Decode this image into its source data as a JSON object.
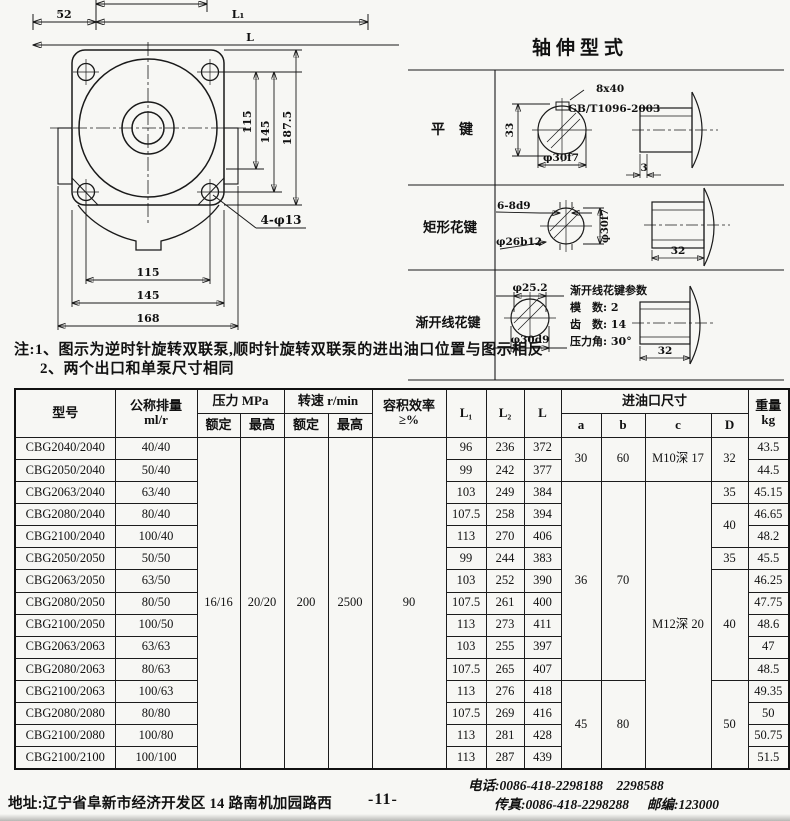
{
  "front_view": {
    "dim_top_52": "52",
    "dim_top_l1": "L₁",
    "dim_top_l": "L",
    "dim_right_115": "115",
    "dim_right_145": "145",
    "dim_right_1875": "187.5",
    "dim_bottom_115": "115",
    "dim_bottom_145": "145",
    "dim_bottom_168": "168",
    "hole_callout": "4-φ13"
  },
  "shaft_types": {
    "title": "轴伸型式",
    "flat_key": {
      "label": "平　键",
      "key_size": "8x40",
      "standard": "GB/T1096-2003",
      "dim_33": "33",
      "dim_dia": "φ30f7",
      "dim_3": "3"
    },
    "rect_spline": {
      "label": "矩形花键",
      "spec": "6-8d9",
      "dia_minor": "φ26b12",
      "dia_major": "φ30f7",
      "dim_32": "32"
    },
    "inv_spline": {
      "label": "渐开线花键",
      "dia_tip": "φ25.2",
      "dia_root": "φ30d9",
      "dim_32": "32",
      "params_title": "渐开线花键参数",
      "param_module": "模　数: 2",
      "param_teeth": "齿　数: 14",
      "param_angle": "压力角: 30°"
    }
  },
  "notes": {
    "line1": "注:1、图示为逆时针旋转双联泵,顺时针旋转双联泵的进出油口位置与图示相反",
    "line2": "2、两个出口和单泵尺寸相同"
  },
  "table": {
    "headers": {
      "model": "型号",
      "displacement_1": "公称排量",
      "displacement_2": "ml/r",
      "pressure": "压力 MPa",
      "speed": "转速 r/min",
      "rated": "额定",
      "max": "最高",
      "efficiency_1": "容积效率",
      "efficiency_2": "≥%",
      "l1": "L₁",
      "l2": "L₂",
      "l": "L",
      "inlet": "进油口尺寸",
      "a": "a",
      "b": "b",
      "c": "c",
      "d": "D",
      "weight_1": "重量",
      "weight_2": "kg"
    },
    "shared": {
      "pressure_rated": "16/16",
      "pressure_max": "20/20",
      "speed_rated": "200",
      "speed_max": "2500",
      "efficiency": "90"
    },
    "inlet": {
      "a1": "30",
      "b1": "60",
      "c1": "M10深 17",
      "d1": "32",
      "a2": "36",
      "b2": "70",
      "c2": "M12深 20",
      "d2": "35",
      "d3": "40",
      "d4": "35",
      "d5": "40",
      "a3": "45",
      "b3": "80",
      "d6": "50"
    },
    "rows": [
      {
        "model": "CBG2040/2040",
        "disp": "40/40",
        "l1": "96",
        "l2": "236",
        "l": "372",
        "kg": "43.5"
      },
      {
        "model": "CBG2050/2040",
        "disp": "50/40",
        "l1": "99",
        "l2": "242",
        "l": "377",
        "kg": "44.5"
      },
      {
        "model": "CBG2063/2040",
        "disp": "63/40",
        "l1": "103",
        "l2": "249",
        "l": "384",
        "kg": "45.15"
      },
      {
        "model": "CBG2080/2040",
        "disp": "80/40",
        "l1": "107.5",
        "l2": "258",
        "l": "394",
        "kg": "46.65"
      },
      {
        "model": "CBG2100/2040",
        "disp": "100/40",
        "l1": "113",
        "l2": "270",
        "l": "406",
        "kg": "48.2"
      },
      {
        "model": "CBG2050/2050",
        "disp": "50/50",
        "l1": "99",
        "l2": "244",
        "l": "383",
        "kg": "45.5"
      },
      {
        "model": "CBG2063/2050",
        "disp": "63/50",
        "l1": "103",
        "l2": "252",
        "l": "390",
        "kg": "46.25"
      },
      {
        "model": "CBG2080/2050",
        "disp": "80/50",
        "l1": "107.5",
        "l2": "261",
        "l": "400",
        "kg": "47.75"
      },
      {
        "model": "CBG2100/2050",
        "disp": "100/50",
        "l1": "113",
        "l2": "273",
        "l": "411",
        "kg": "48.6"
      },
      {
        "model": "CBG2063/2063",
        "disp": "63/63",
        "l1": "103",
        "l2": "255",
        "l": "397",
        "kg": "47"
      },
      {
        "model": "CBG2080/2063",
        "disp": "80/63",
        "l1": "107.5",
        "l2": "265",
        "l": "407",
        "kg": "48.5"
      },
      {
        "model": "CBG2100/2063",
        "disp": "100/63",
        "l1": "113",
        "l2": "276",
        "l": "418",
        "kg": "49.35"
      },
      {
        "model": "CBG2080/2080",
        "disp": "80/80",
        "l1": "107.5",
        "l2": "269",
        "l": "416",
        "kg": "50"
      },
      {
        "model": "CBG2100/2080",
        "disp": "100/80",
        "l1": "113",
        "l2": "281",
        "l": "428",
        "kg": "50.75"
      },
      {
        "model": "CBG2100/2100",
        "disp": "100/100",
        "l1": "113",
        "l2": "287",
        "l": "439",
        "kg": "51.5"
      }
    ]
  },
  "footer": {
    "address": "地址:辽宁省阜新市经济开发区 14 路南机加园路西",
    "page": "-11-",
    "phone": "电话:0086-418-2298188　2298588",
    "fax": "传真:0086-418-2298288",
    "zip": "邮编:123000"
  }
}
